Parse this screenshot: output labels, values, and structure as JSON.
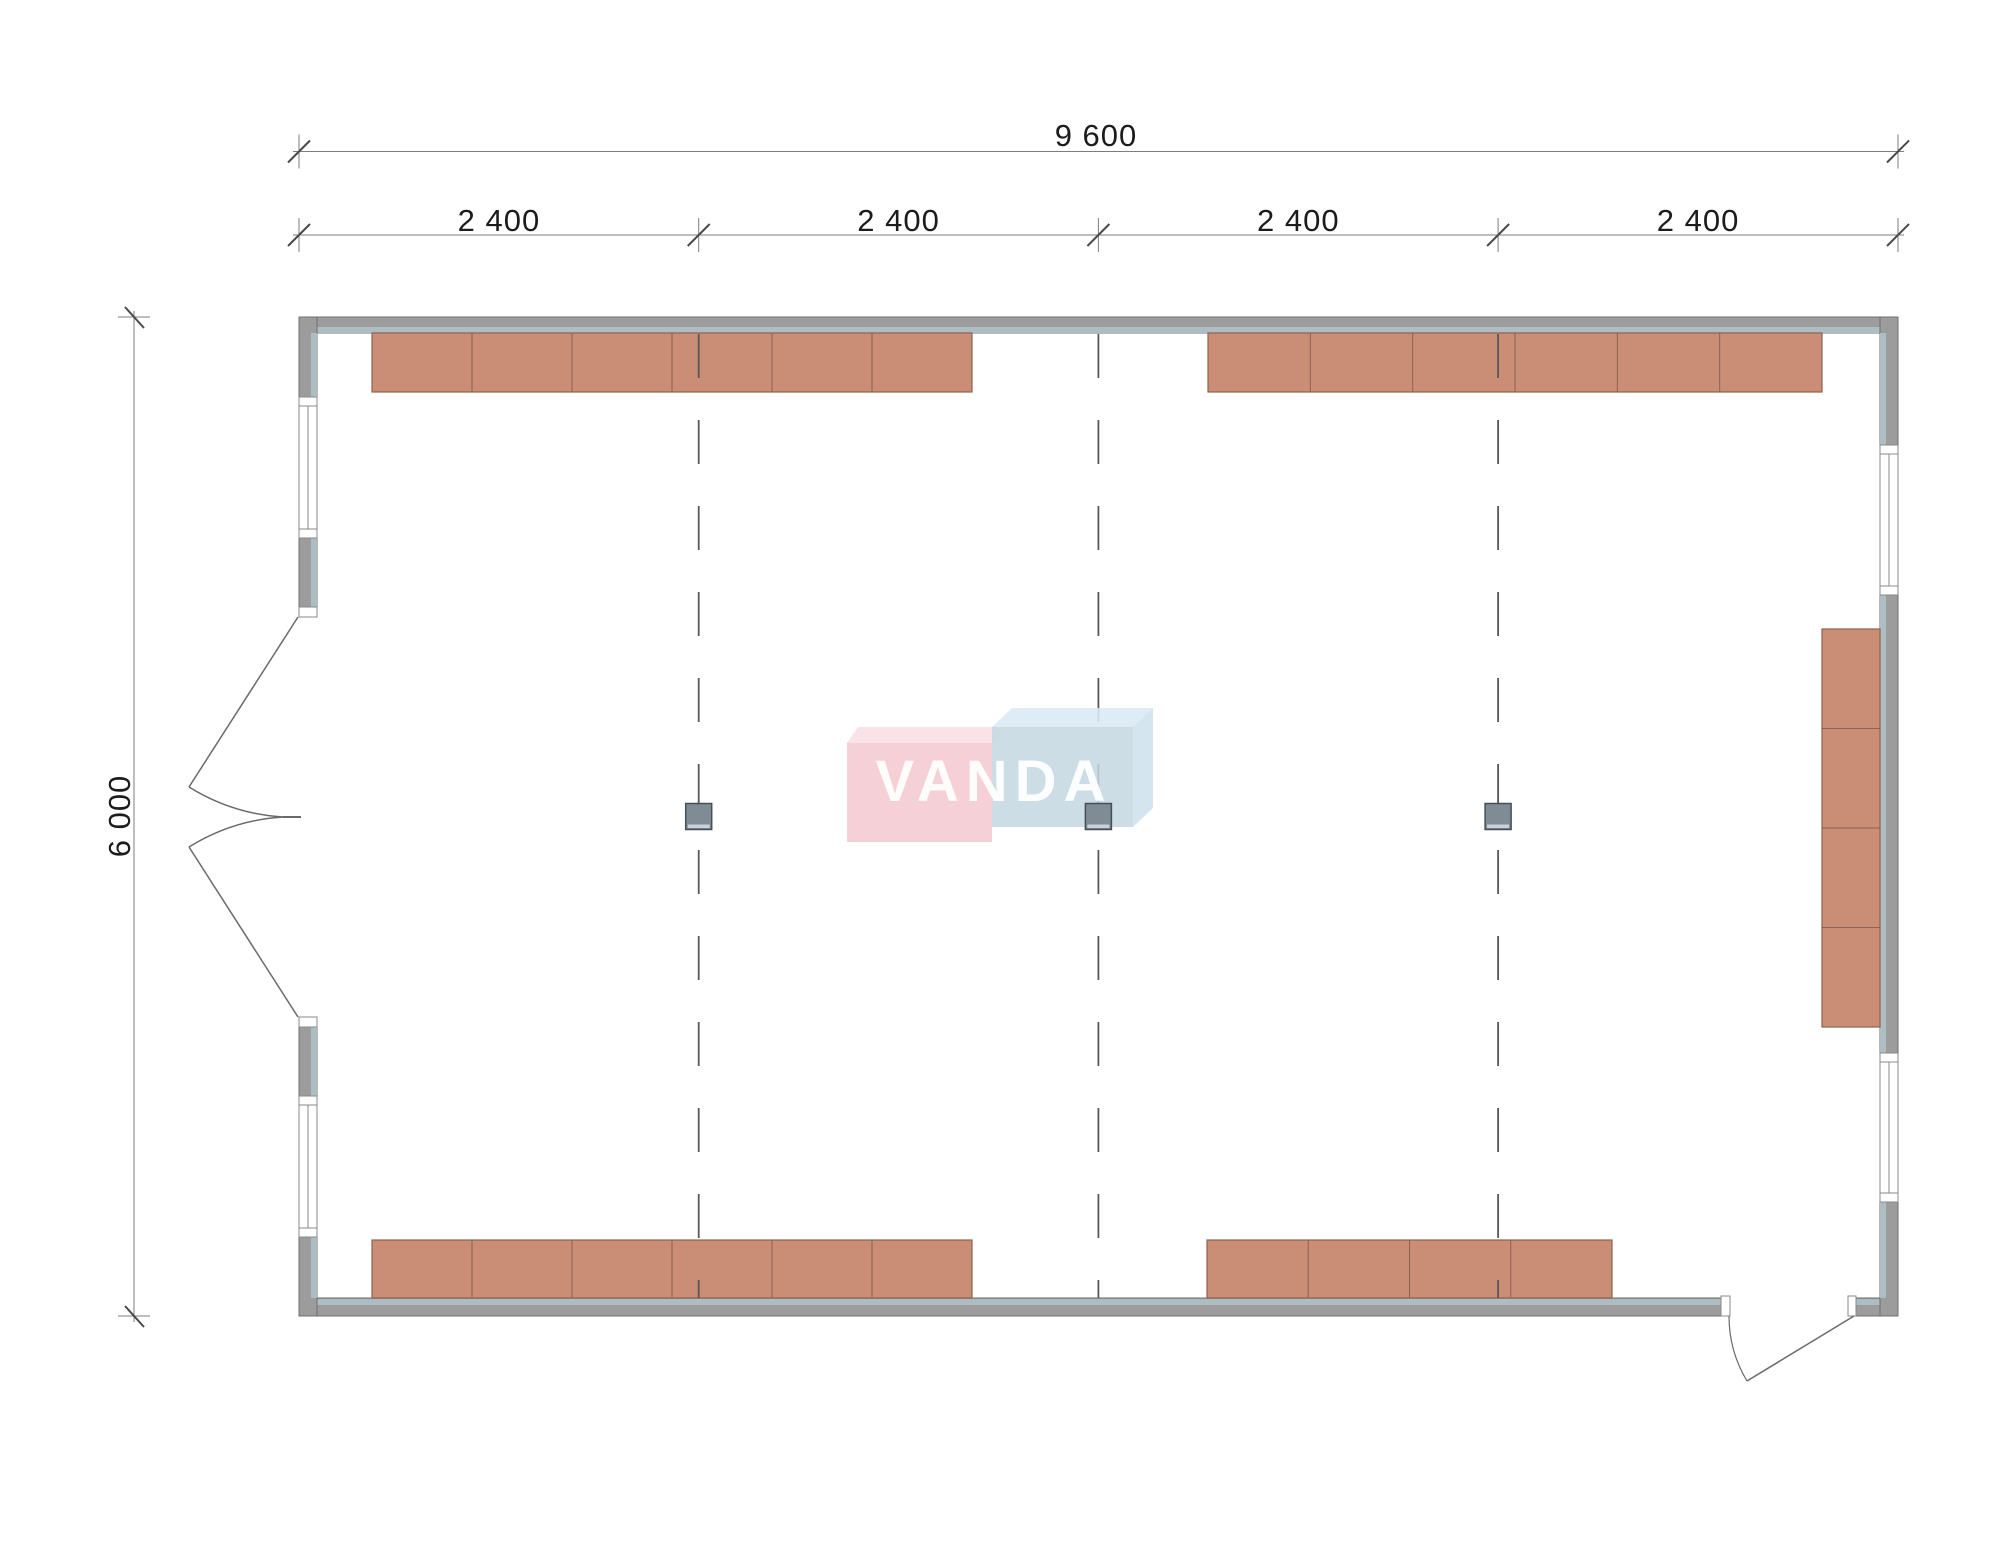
{
  "title": "Floor plan 9600 x 6000 - VANDA",
  "canvas": {
    "w": 2000,
    "h": 1550,
    "bg": "#ffffff"
  },
  "colors": {
    "wall_fill": "#9c9c9c",
    "wall_stroke": "#6f6f6f",
    "wall_inner_strip": "#aebdc2",
    "window_fill": "#ffffff",
    "window_stroke": "#8a8a8a",
    "furniture_fill": "#c98e75",
    "furniture_stroke": "#90604f",
    "grid_line": "#585858",
    "column_fill": "#7f8b95",
    "column_stroke": "#454f58",
    "column_base": "#c9d2d8",
    "dim_line": "#7d7d7d",
    "dim_slash": "#4a4a4a",
    "door_stroke": "#6a6a6a",
    "logo_pink_front": "rgba(243,198,206,0.82)",
    "logo_pink_top": "rgba(249,222,228,0.85)",
    "logo_blue_front": "rgba(196,215,226,0.85)",
    "logo_blue_top": "rgba(216,233,244,0.88)",
    "logo_blue_side": "rgba(205,224,236,0.85)"
  },
  "dimensions": {
    "overall_width": {
      "label": "9 600",
      "y": 151.5,
      "x1": 299,
      "x2": 1898,
      "label_x": 1096,
      "label_y": 146
    },
    "bays": {
      "label": "2 400",
      "y": 235,
      "ticks": [
        299,
        698.7,
        1098.4,
        1498.1,
        1898
      ],
      "labels": [
        {
          "text": "2 400",
          "x": 498.9
        },
        {
          "text": "2 400",
          "x": 898.6
        },
        {
          "text": "2 400",
          "x": 1298.3
        },
        {
          "text": "2 400",
          "x": 1698.1
        }
      ]
    },
    "overall_height": {
      "label": "6 000",
      "x": 134,
      "y1": 317,
      "y2": 1316,
      "label_x": 130,
      "label_y": 816
    }
  },
  "walls": [
    {
      "name": "wall-top",
      "x": 299,
      "y": 317,
      "w": 1599,
      "h": 16,
      "strip": {
        "x": 317,
        "y": 327,
        "w": 1563,
        "h": 6
      }
    },
    {
      "name": "wall-bottom",
      "x": 299,
      "y": 1298,
      "w": 1599,
      "h": 18,
      "strip": {
        "x": 317,
        "y": 1299,
        "w": 1563,
        "h": 6
      }
    },
    {
      "name": "wall-left",
      "x": 299,
      "y": 317,
      "w": 18,
      "h": 999,
      "strip": {
        "x": 311,
        "y": 333,
        "w": 6,
        "h": 965
      }
    },
    {
      "name": "wall-right",
      "x": 1880,
      "y": 317,
      "w": 18,
      "h": 999,
      "strip": {
        "x": 1880,
        "y": 333,
        "w": 6,
        "h": 965
      }
    }
  ],
  "door_gaps": [
    {
      "name": "double-door-opening",
      "x": 298,
      "y": 617,
      "w": 20,
      "h": 400
    },
    {
      "name": "entry-door-opening",
      "x": 1730,
      "y": 1297,
      "w": 118,
      "h": 20
    }
  ],
  "jambs": [
    {
      "x": 299,
      "y": 607,
      "w": 18,
      "h": 10
    },
    {
      "x": 299,
      "y": 1017,
      "w": 18,
      "h": 10
    },
    {
      "x": 1721,
      "y": 1296,
      "w": 9,
      "h": 20
    },
    {
      "x": 1848,
      "y": 1296,
      "w": 8,
      "h": 20
    }
  ],
  "windows": [
    {
      "name": "window-left-upper",
      "x": 299,
      "y": 397,
      "w": 18,
      "h": 141,
      "orient": "v"
    },
    {
      "name": "window-left-lower",
      "x": 299,
      "y": 1096,
      "w": 18,
      "h": 141,
      "orient": "v"
    },
    {
      "name": "window-right-upper",
      "x": 1880,
      "y": 445,
      "w": 18,
      "h": 150,
      "orient": "v"
    },
    {
      "name": "window-right-lower",
      "x": 1880,
      "y": 1053,
      "w": 18,
      "h": 149,
      "orient": "v"
    }
  ],
  "doors": {
    "double": {
      "leaves": [
        {
          "x1": 298,
          "y1": 617,
          "x2": 189,
          "y2": 787
        },
        {
          "x1": 298,
          "y1": 1017,
          "x2": 189,
          "y2": 847
        }
      ],
      "arcs": [
        "M 189 787 A 201 201 0 0 0 283 817",
        "M 189 847 A 201 201 0 0 1 283 817"
      ],
      "tick": {
        "x1": 283,
        "y1": 817,
        "x2": 301,
        "y2": 817
      }
    },
    "single": {
      "leaf": {
        "x1": 1854,
        "y1": 1316,
        "x2": 1747,
        "y2": 1381
      },
      "arc": "M 1729 1316 A 126 126 0 0 0 1747 1381"
    }
  },
  "furniture": [
    {
      "name": "cabinet-row-top-left",
      "x": 372,
      "y": 333,
      "w": 600,
      "h": 59,
      "cells": 6,
      "dir": "h"
    },
    {
      "name": "cabinet-row-top-right",
      "x": 1208,
      "y": 333,
      "w": 614,
      "h": 59,
      "cells": 6,
      "dir": "h"
    },
    {
      "name": "cabinet-row-bottom-left",
      "x": 372,
      "y": 1240,
      "w": 600,
      "h": 58,
      "cells": 6,
      "dir": "h"
    },
    {
      "name": "cabinet-row-bottom-right",
      "x": 1207,
      "y": 1240,
      "w": 405,
      "h": 58,
      "cells": 4,
      "dir": "h"
    },
    {
      "name": "cabinet-column-right",
      "x": 1822,
      "y": 629,
      "w": 58,
      "h": 398,
      "cells": 4,
      "dir": "v"
    }
  ],
  "grid": {
    "xs": [
      698.7,
      1098.4,
      1498.1
    ],
    "y1": 334,
    "y2": 1298,
    "dash": "44 42"
  },
  "columns": {
    "size": 26,
    "centers": [
      {
        "cx": 698.7,
        "cy": 816.5
      },
      {
        "cx": 1098.4,
        "cy": 816.5
      },
      {
        "cx": 1498.1,
        "cy": 816.5
      }
    ]
  },
  "watermark": {
    "text": "VANDA",
    "text_x": 994,
    "text_y": 801,
    "pink_front": {
      "x": 847,
      "y": 743,
      "w": 145,
      "h": 99
    },
    "pink_top": "847,743 858,727 1003,727 992,743",
    "blue_front": {
      "x": 992,
      "y": 727,
      "w": 141,
      "h": 100
    },
    "blue_top": "992,727 1012,708 1153,708 1133,727",
    "blue_side": "1133,727 1153,708 1153,808 1133,827"
  }
}
